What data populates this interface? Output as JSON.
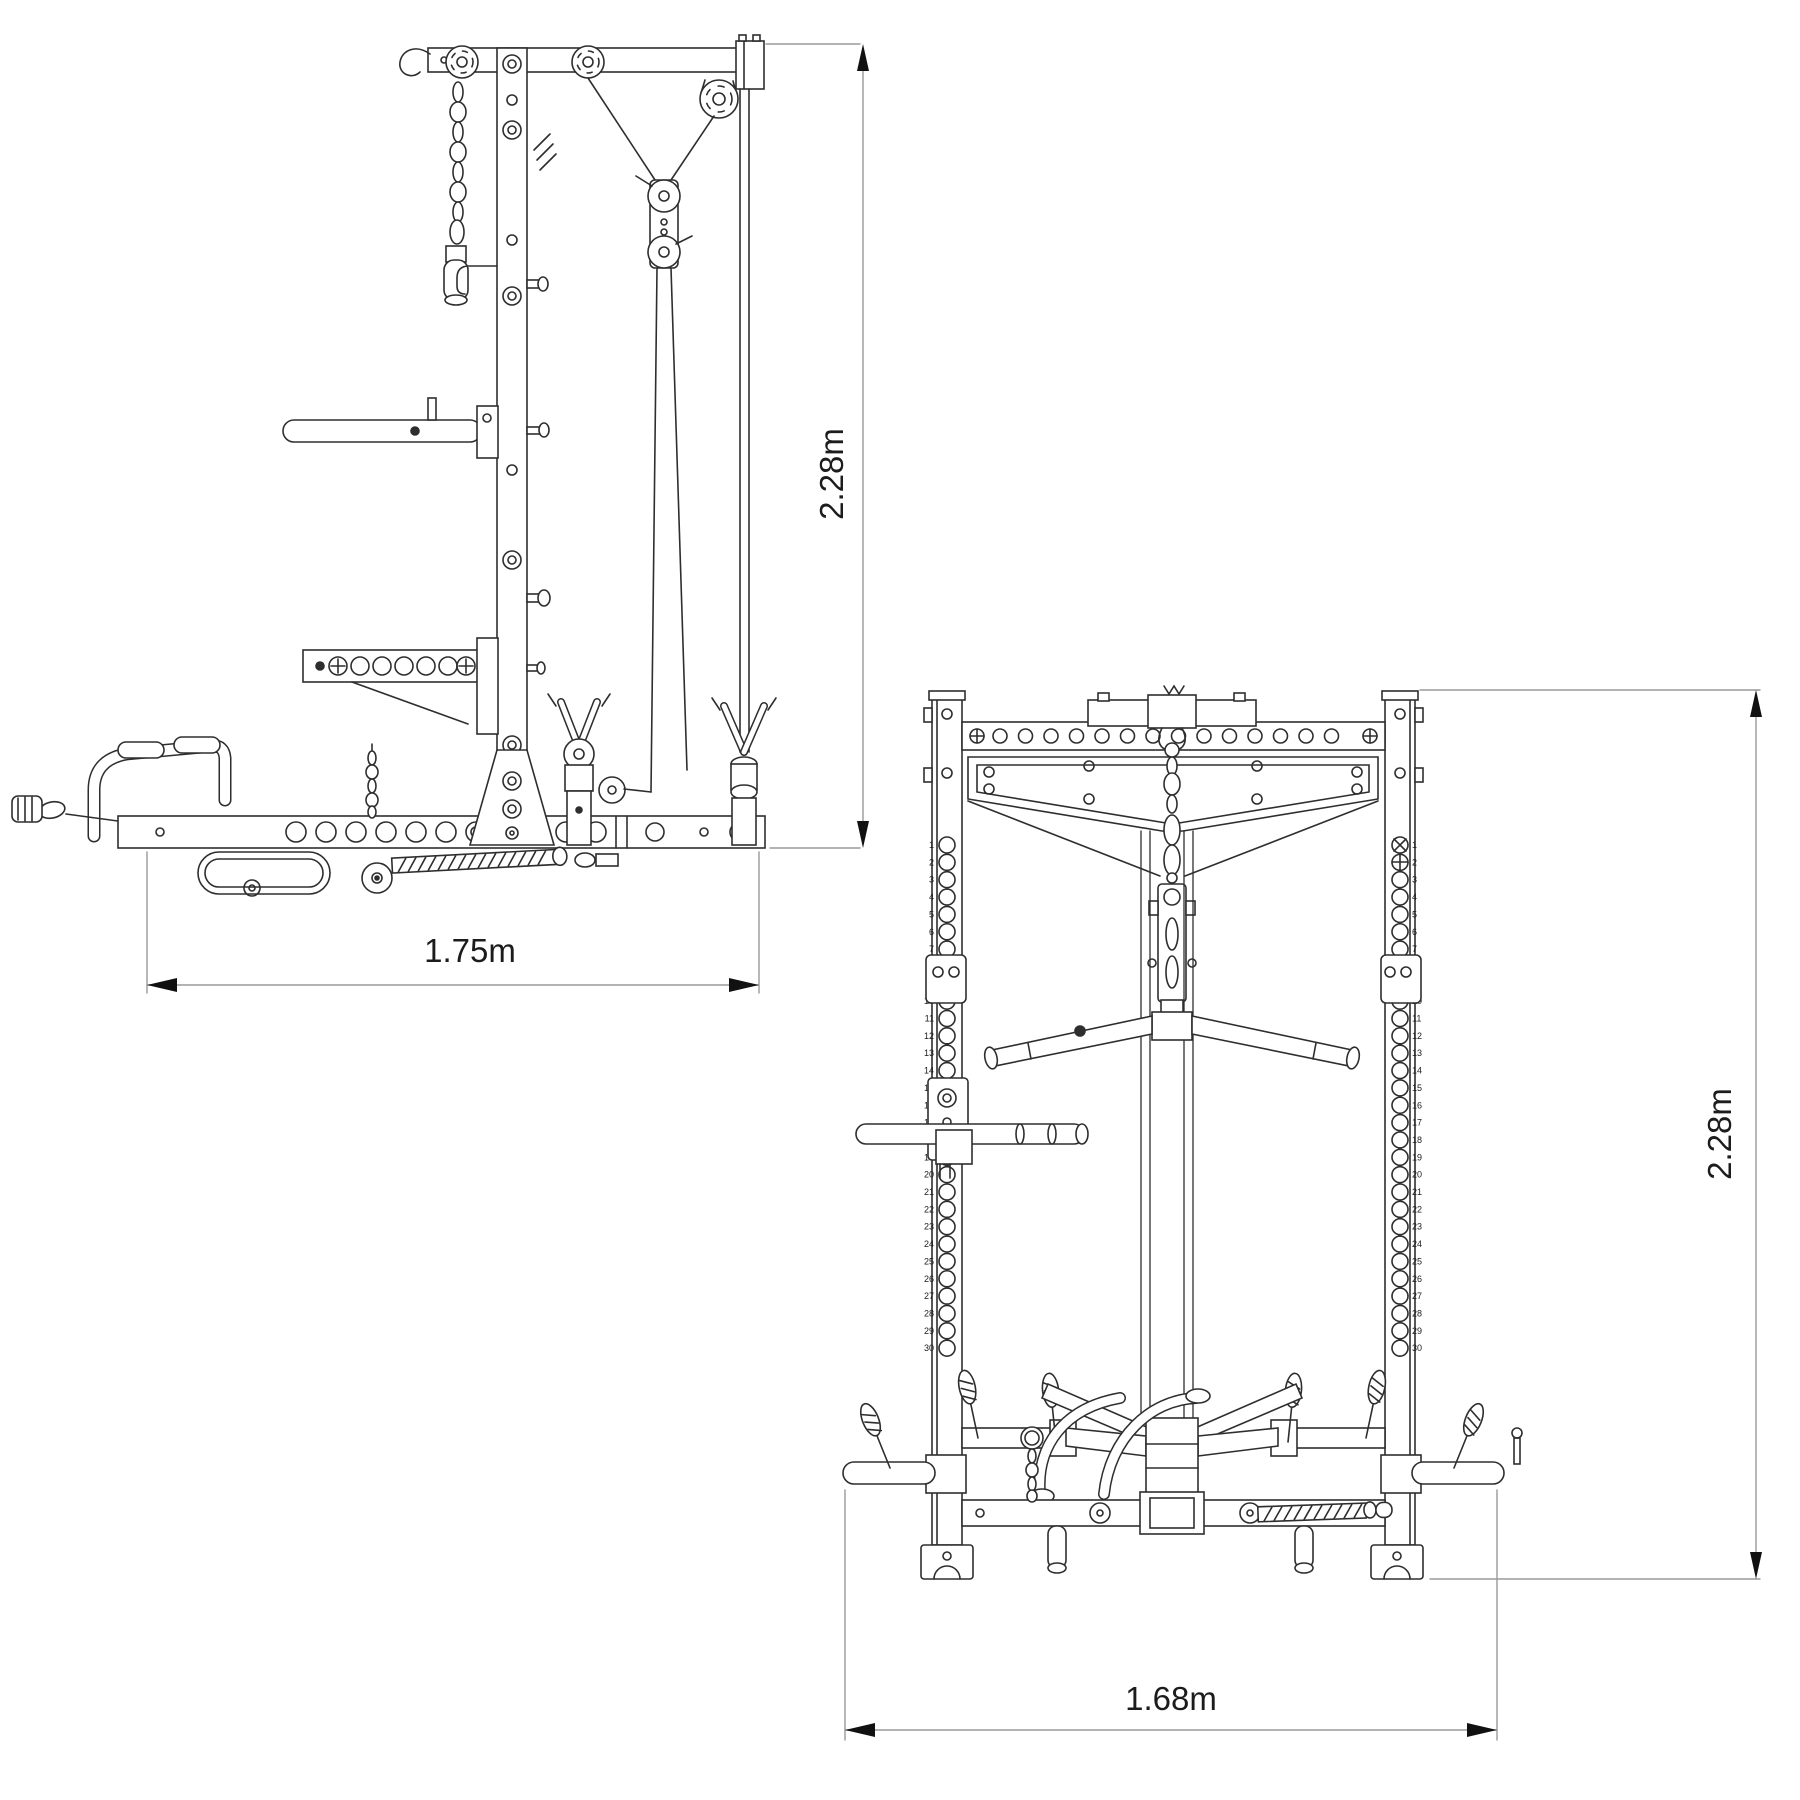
{
  "page": {
    "background": "#ffffff"
  },
  "drawing": {
    "stroke_color": "#2e2e2e",
    "dim_color": "#1c1c1c",
    "side_view": {
      "name": "lat-tower-side-view",
      "height_dim_label": "2.28m",
      "width_dim_label": "1.75m"
    },
    "front_view": {
      "name": "rack-front-view",
      "height_dim_label": "2.28m",
      "width_dim_label": "1.68m",
      "upright_hole_count": 30
    }
  }
}
